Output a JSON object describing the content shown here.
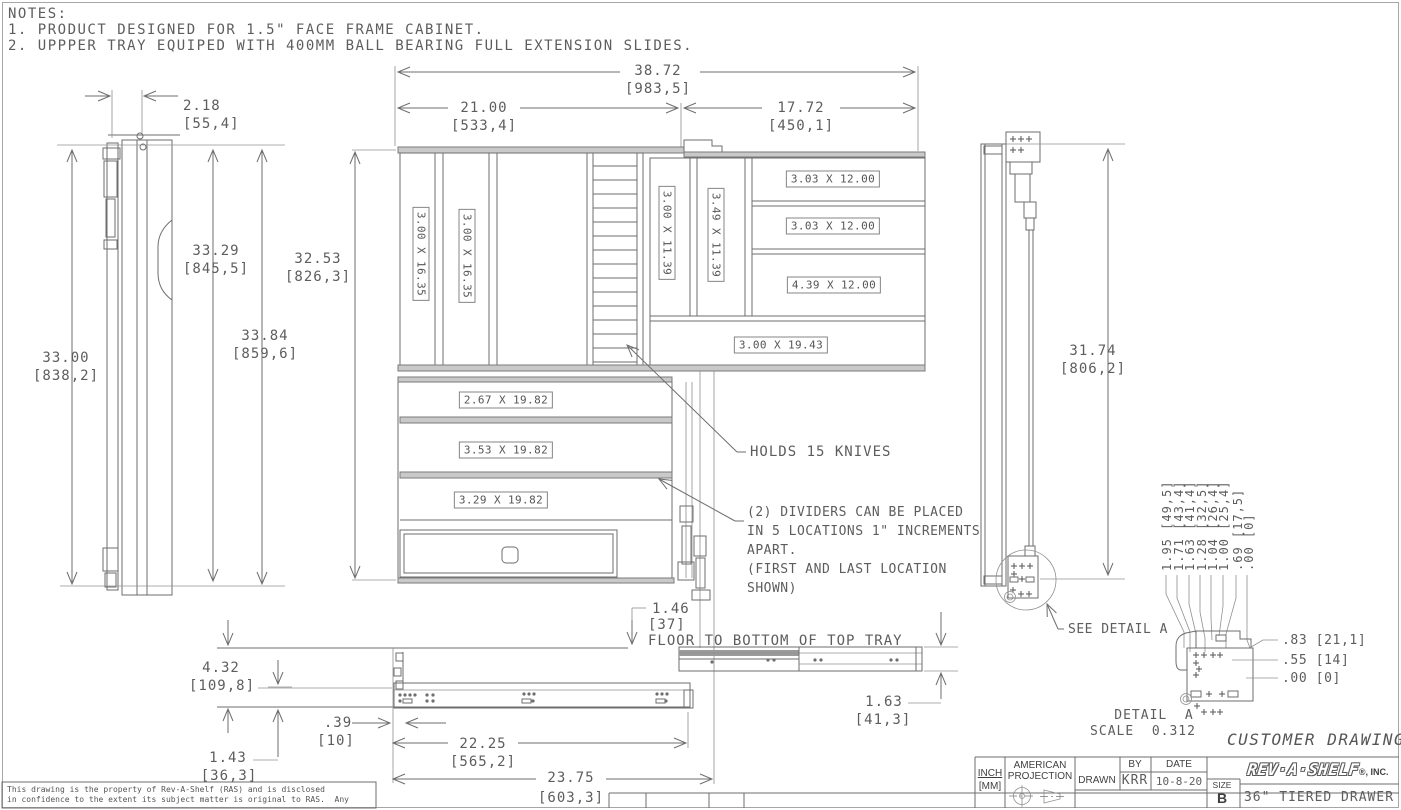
{
  "notes": {
    "title": "NOTES:",
    "line1": "1. PRODUCT DESIGNED FOR 1.5\" FACE FRAME CABINET.",
    "line2": "2. UPPPER TRAY EQUIPED WITH 400MM BALL BEARING FULL EXTENSION SLIDES."
  },
  "left_view": {
    "dim_2_18": "2.18",
    "dim_2_18_mm": "[55,4]",
    "dim_33_29": "33.29",
    "dim_33_29_mm": "[845,5]",
    "dim_33_84": "33.84",
    "dim_33_84_mm": "[859,6]",
    "dim_33_00": "33.00",
    "dim_33_00_mm": "[838,2]"
  },
  "front_view": {
    "dim_38_72": "38.72",
    "dim_38_72_mm": "[983,5]",
    "dim_21_00": "21.00",
    "dim_21_00_mm": "[533,4]",
    "dim_17_72": "17.72",
    "dim_17_72_mm": "[450,1]",
    "dim_32_53": "32.53",
    "dim_32_53_mm": "[826,3]",
    "tray_slots": {
      "s1": "3.00 X 16.35",
      "s2": "3.00 X 16.35",
      "s3": "3.00 X 11.39",
      "s4": "3.49 X 11.39",
      "s5": "3.03 X 12.00",
      "s6": "3.03 X 12.00",
      "s7": "4.39 X 12.00",
      "s8": "3.00 X 19.43"
    },
    "drawer_slots": {
      "s1": "2.67 X 19.82",
      "s2": "3.53 X 19.82",
      "s3": "3.29 X 19.82"
    },
    "knives_callout": "HOLDS 15 KNIVES",
    "dividers_l1": "(2) DIVIDERS CAN BE PLACED",
    "dividers_l2": "IN 5 LOCATIONS 1\" INCREMENTS",
    "dividers_l3": "APART.",
    "dividers_l4": "(FIRST AND LAST LOCATION",
    "dividers_l5": "SHOWN)"
  },
  "right_view": {
    "dim_31_74": "31.74",
    "dim_31_74_mm": "[806,2]",
    "see_detail": "SEE DETAIL A"
  },
  "detail_a": {
    "stack": [
      "1.95 [49,5]",
      "1.71 [43,4]",
      "1.63 [41,4]",
      "1.28 [32,5]",
      "1.04 [26,4]",
      "1.00 [25,4]",
      ".69 [17,5]",
      ".00 [0]"
    ],
    "dim_83": ".83 [21,1]",
    "dim_55": ".55 [14]",
    "dim_00": ".00 [0]",
    "caption": "DETAIL  A",
    "scale": "SCALE  0.312"
  },
  "bottom_view": {
    "dim_4_32": "4.32",
    "dim_4_32_mm": "[109,8]",
    "dim_1_43": "1.43",
    "dim_1_43_mm": "[36,3]",
    "dim_39": ".39",
    "dim_39_mm": "[10]",
    "dim_22_25": "22.25",
    "dim_22_25_mm": "[565,2]",
    "dim_23_75": "23.75",
    "dim_23_75_mm": "[603,3]",
    "dim_1_46": "1.46",
    "dim_1_46_mm": "[37]",
    "floor_note": "FLOOR TO BOTTOM OF TOP TRAY",
    "dim_1_63": "1.63",
    "dim_1_63_mm": "[41,3]"
  },
  "title_block": {
    "customer_drawing": "CUSTOMER DRAWING",
    "inch": "INCH",
    "mm": "[MM]",
    "projection1": "AMERICAN",
    "projection2": "PROJECTION",
    "drawn": "DRAWN",
    "by": "BY",
    "date": "DATE",
    "drawn_by_value": "KRR",
    "date_value": "10-8-20",
    "logo": "REV·A·SHELF",
    "logo_suffix": "®, INC.",
    "size": "SIZE",
    "size_value": "B",
    "title": "36\" TIERED DRAWER"
  },
  "disclaimer": {
    "line1": "This drawing is the property of Rev-A-Shelf (RAS) and is disclosed",
    "line2": "in confidence to the extent its subject matter is original to RAS.  Any"
  }
}
